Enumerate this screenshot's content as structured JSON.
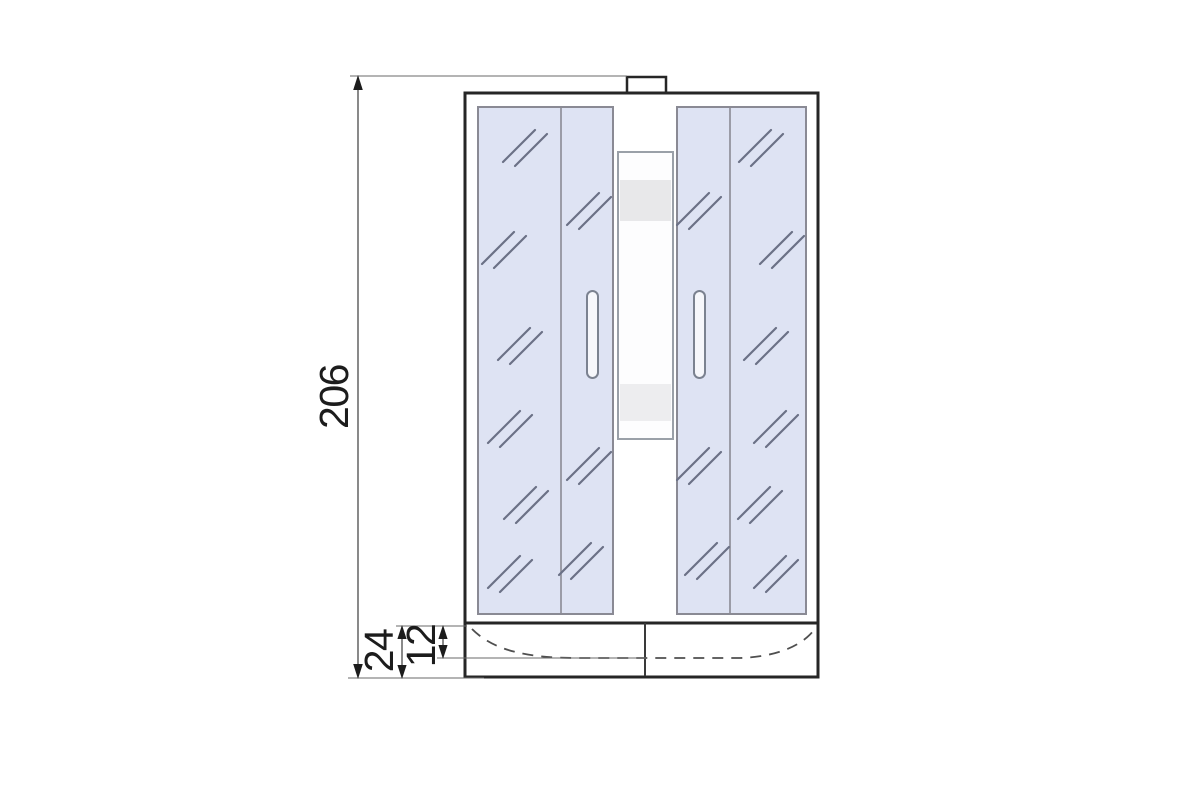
{
  "diagram": {
    "type": "technical-dimension-drawing",
    "subject": "shower-cabin-front-elevation",
    "dimensions": {
      "total_height": {
        "label": "206",
        "orientation": "vertical",
        "measures": "overall cabin height"
      },
      "tray_height": {
        "label": "24",
        "orientation": "vertical",
        "measures": "shower tray overall height"
      },
      "basin_depth": {
        "label": "12",
        "orientation": "vertical",
        "measures": "tray rim to basin line depth"
      }
    },
    "colors": {
      "background": "#ffffff",
      "outline": "#262626",
      "glass_fill": "#dee3f3",
      "glass_border": "#8a8a94",
      "reflection_stroke": "#6b7186",
      "dimension_line": "#4a4a4a",
      "label_text": "#1c1c1c",
      "panel_band_upper": "#e8e8ea",
      "panel_band_lower": "#ededef",
      "handle_fill": "#f6f7fb"
    },
    "glass_marks": [
      {
        "x": 525,
        "y": 146
      },
      {
        "x": 504,
        "y": 248
      },
      {
        "x": 520,
        "y": 344
      },
      {
        "x": 510,
        "y": 427
      },
      {
        "x": 526,
        "y": 503
      },
      {
        "x": 510,
        "y": 572
      },
      {
        "x": 589,
        "y": 209
      },
      {
        "x": 589,
        "y": 464
      },
      {
        "x": 581,
        "y": 559
      },
      {
        "x": 699,
        "y": 209
      },
      {
        "x": 699,
        "y": 464
      },
      {
        "x": 707,
        "y": 559
      },
      {
        "x": 761,
        "y": 146
      },
      {
        "x": 782,
        "y": 248
      },
      {
        "x": 766,
        "y": 344
      },
      {
        "x": 776,
        "y": 427
      },
      {
        "x": 760,
        "y": 503
      },
      {
        "x": 776,
        "y": 572
      }
    ]
  }
}
